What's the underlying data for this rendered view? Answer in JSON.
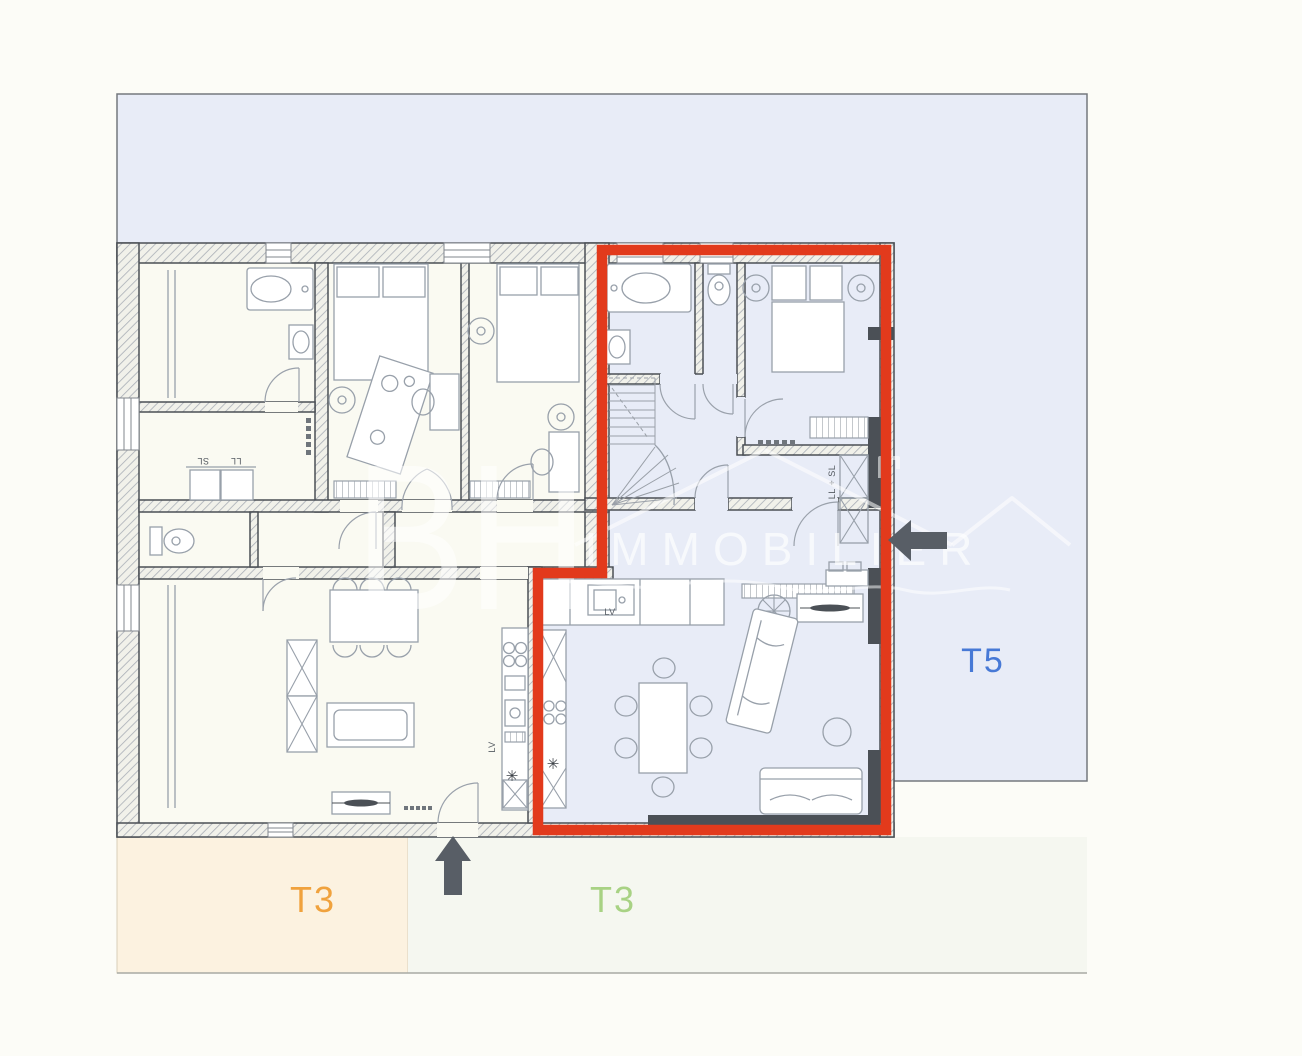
{
  "units": {
    "t3_left": {
      "label": "T3",
      "color": "#f0a23d"
    },
    "t3_right": {
      "label": "T3",
      "color": "#a8d284"
    },
    "t5": {
      "label": "T5",
      "color": "#4779d6",
      "highlighted": true
    }
  },
  "watermark": {
    "initials": "BH",
    "name": "IMMOBILIER"
  },
  "annotations": {
    "dishwasher_t5": "LV",
    "dishwasher_left": "LV",
    "dryer": "SL",
    "washer": "LL",
    "washer_dryer": "LL + SL",
    "appliance_marker": "✳"
  },
  "colors": {
    "selection_outline": "#e23a1c",
    "zone_blue": "#e8ecf7",
    "zone_cream": "#fcf2e0",
    "zone_pale": "#f5f7f0",
    "interior": "#fafaf2",
    "arrow": "#585e66"
  }
}
